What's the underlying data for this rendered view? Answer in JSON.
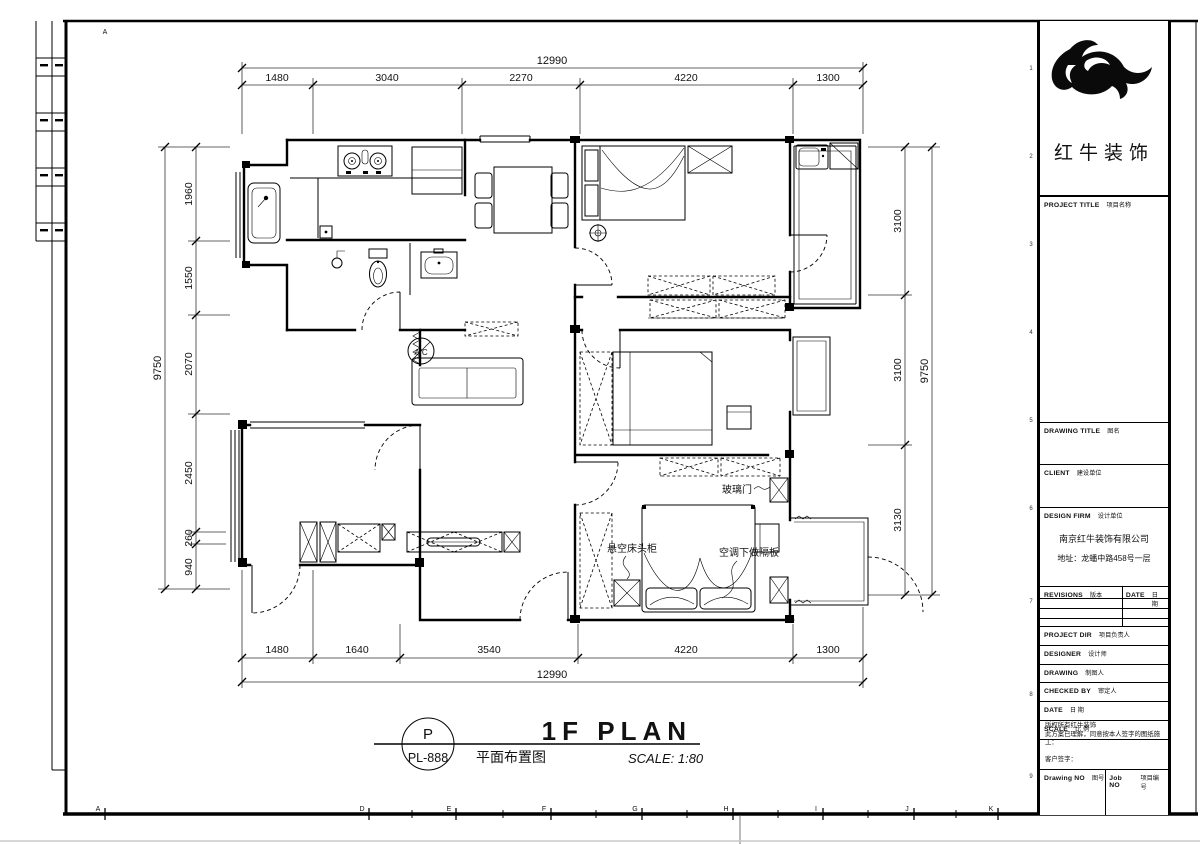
{
  "sheet": {
    "border_letter_top": "A",
    "border_letters_bottom": [
      "A",
      "D",
      "E",
      "F",
      "G",
      "H",
      "I",
      "J",
      "K"
    ],
    "border_numbers_right": [
      "1",
      "2",
      "3",
      "4",
      "5",
      "6",
      "7",
      "8",
      "9"
    ]
  },
  "dimensions": {
    "top": {
      "overall": "12990",
      "segments": [
        "1480",
        "3040",
        "2270",
        "4220",
        "1300"
      ]
    },
    "bottom": {
      "overall": "12990",
      "segments": [
        "1480",
        "1640",
        "3540",
        "4220",
        "1300"
      ]
    },
    "left": {
      "overall": "9750",
      "segments": [
        "1960",
        "1550",
        "2070",
        "2450",
        "260",
        "940"
      ]
    },
    "right": {
      "overall": "9750",
      "segments": [
        "3100",
        "3100",
        "3130"
      ]
    }
  },
  "plan_labels": {
    "glass_door": "玻璃门",
    "floating_nightstand": "悬空床头柜",
    "ac_shelf": "空调下做隔板",
    "ac_symbol": "A/C"
  },
  "footer": {
    "sheet_letter": "P",
    "sheet_no": "PL-888",
    "title_en": "1F PLAN",
    "title_cn": "平面布置图",
    "scale": "SCALE: 1:80"
  },
  "title_block": {
    "brand": "红牛装饰",
    "project_title_en": "PROJECT TITLE",
    "project_title_cn": "项目名称",
    "drawing_title_en": "DRAWING TITLE",
    "drawing_title_cn": "图名",
    "client_en": "CLIENT",
    "client_cn": "建设单位",
    "design_firm_en": "DESIGN FIRM",
    "design_firm_cn": "设计单位",
    "company": "南京红牛装饰有限公司",
    "address": "地址：龙蟠中路458号一层",
    "revisions_en": "REVISIONS",
    "revisions_cn": "版本",
    "date_col_en": "DATE",
    "date_col_cn": "日期",
    "rows": [
      {
        "en": "PROJECT DIR",
        "cn": "项目负责人"
      },
      {
        "en": "DESIGNER",
        "cn": "设计师"
      },
      {
        "en": "DRAWING",
        "cn": "制图人"
      },
      {
        "en": "CHECKED BY",
        "cn": "审定人"
      },
      {
        "en": "DATE",
        "cn": "日 期"
      },
      {
        "en": "SCALE",
        "cn": "比 例"
      }
    ],
    "note_line1": "版权所有红牛装饰",
    "note_line2": "此方案已理解，同意按本人签字的图纸施工：",
    "note_line3": "客户签字：",
    "drawing_no_en": "Drawing NO",
    "drawing_no_cn": "图号",
    "job_no_en": "Job NO",
    "job_no_cn": "项目编号"
  }
}
